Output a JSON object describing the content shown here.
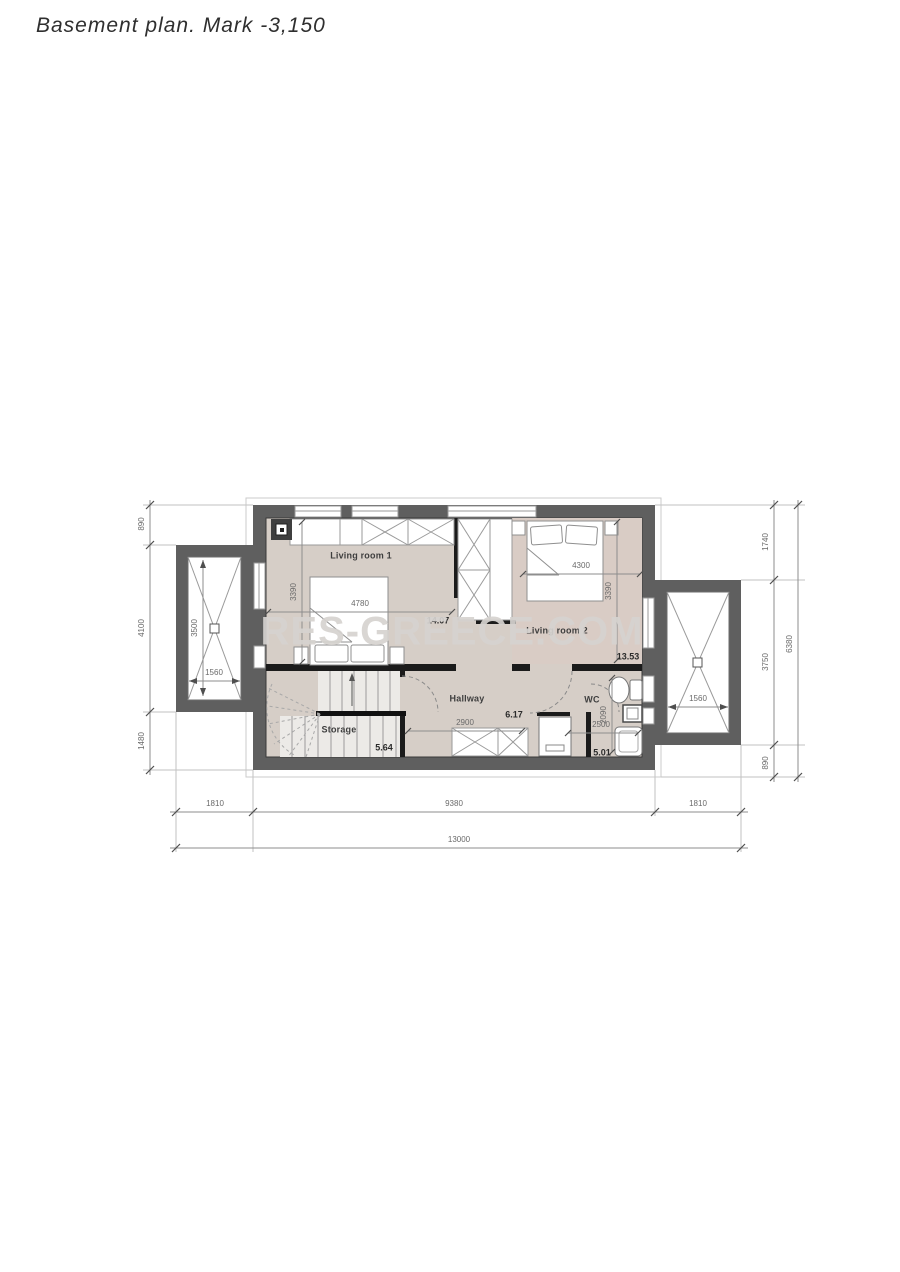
{
  "title": "Basement plan. Mark -3,150",
  "watermark": "RES-GREECE.COM",
  "colors": {
    "wall": "#5f5f5f",
    "floor": "#d6cec7",
    "floor_bedroom2": "#d9ccc5",
    "watermark": "#d6d3d0",
    "dim_text": "#6a6a6a"
  },
  "rooms": {
    "living1": {
      "label": "Living room 1",
      "area": "14.07",
      "width_mm": "4780",
      "depth_mm": "3390"
    },
    "living2": {
      "label": "Living room 2",
      "area": "13.53",
      "width_mm": "4300",
      "depth_mm": "3390"
    },
    "hallway": {
      "label": "Hallway",
      "area": "6.17",
      "width_mm": "2900"
    },
    "storage": {
      "label": "Storage",
      "area": "5.64"
    },
    "wc": {
      "label": "WC",
      "area": "5.01",
      "width_mm": "2500",
      "depth_mm": "2090"
    }
  },
  "dimensions": {
    "left_chain": {
      "top": "890",
      "middle": "4100",
      "bottom": "1480"
    },
    "right_chain": {
      "top": "1740",
      "middle": "3750",
      "bottom": "890",
      "overall": "6380"
    },
    "bottom_chain": {
      "left": "1810",
      "middle": "9380",
      "right": "1810",
      "overall": "13000"
    },
    "lightwell_left": {
      "depth": "3500",
      "width": "1560"
    },
    "lightwell_right": {
      "width": "1560"
    }
  }
}
